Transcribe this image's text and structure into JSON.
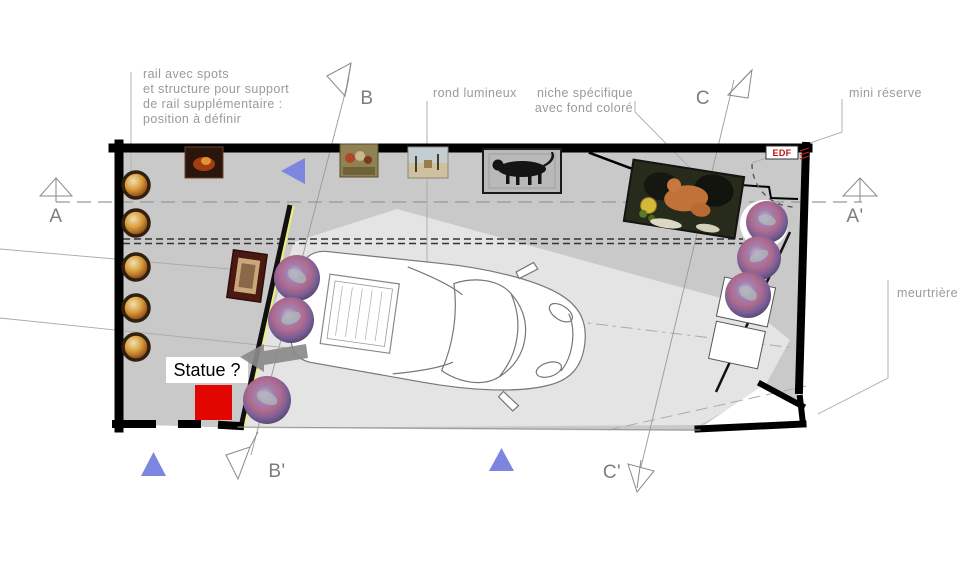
{
  "plan_title": "garage-gallery floor plan",
  "annotations": {
    "rail_note": [
      "rail avec spots",
      "et structure pour support",
      "de rail supplémentaire :",
      "position à définir"
    ],
    "rond": "rond lumineux",
    "niche": [
      "niche spécifique",
      "avec fond coloré"
    ],
    "mini_reserve": "mini réserve",
    "meurtriere": "meurtrière",
    "statue": "Statue ?",
    "edf": "EDF"
  },
  "markers": {
    "a": "A",
    "a_prime": "A'",
    "b": "B",
    "b_prime": "B'",
    "c": "C",
    "c_prime": "C'"
  },
  "colors": {
    "wall": "#000000",
    "floor": "#c9c9c9",
    "drive_lane": "#e4e4e4",
    "statue_red": "#e10600",
    "arrow_gray": "#8a8a8a",
    "triangle_blue": "#7c86df",
    "rail_yellow": "#f0ee7a",
    "annotation_gray": "#9a9a9a",
    "edf_red": "#c01010"
  },
  "objects": {
    "car": "sports car top view",
    "wall_paintings": 4,
    "niche_painting": 1,
    "round_plates_left_wall": 5,
    "mosaic_discs": 6
  }
}
